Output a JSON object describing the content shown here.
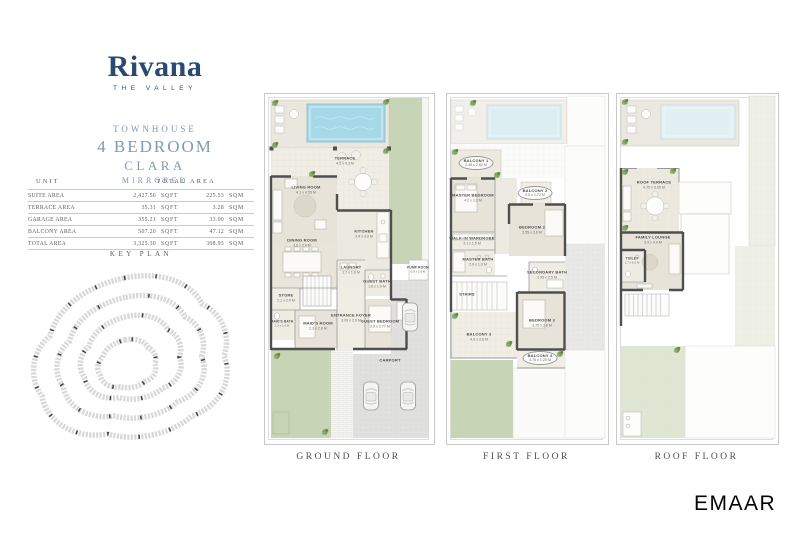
{
  "brand": {
    "logo": "Rivana",
    "tagline": "THE VALLEY",
    "emaar_logo": "EMAAR"
  },
  "unit": {
    "type": "TOWNHOUSE",
    "bedrooms": "4 BEDROOM",
    "name": "CLARA",
    "variant": "MIRRORED"
  },
  "colors": {
    "brand_navy": "#2b4a72",
    "subtitle_blue": "#7e9ab4",
    "pool_blue": "#a6d9e8",
    "garden_green": "#c7d4b5"
  },
  "area_table": {
    "header_unit": "UNIT",
    "header_total": "TOTAL AREA",
    "rows": [
      {
        "label": "SUITE AREA",
        "sqft": "2,427.56",
        "sqft_unit": "SQFT",
        "sqm": "225.53",
        "sqm_unit": "SQM"
      },
      {
        "label": "TERRACE AREA",
        "sqft": "35.31",
        "sqft_unit": "SQFT",
        "sqm": "3.28",
        "sqm_unit": "SQM"
      },
      {
        "label": "GARAGE AREA",
        "sqft": "355.21",
        "sqft_unit": "SQFT",
        "sqm": "33.00",
        "sqm_unit": "SQM"
      },
      {
        "label": "BALCONY AREA",
        "sqft": "507.20",
        "sqft_unit": "SQFT",
        "sqm": "47.12",
        "sqm_unit": "SQM"
      },
      {
        "label": "TOTAL AREA",
        "sqft": "3,325.30",
        "sqft_unit": "SQFT",
        "sqm": "308.93",
        "sqm_unit": "SQM"
      }
    ]
  },
  "key_plan": {
    "title": "KEY PLAN"
  },
  "floors": {
    "ground": {
      "label": "GROUND FLOOR",
      "rooms": {
        "terrace": {
          "name": "TERRACE",
          "dims": "4.5 x 4.3 M"
        },
        "living": {
          "name": "LIVING ROOM",
          "dims": "4.1 x 4.55 M"
        },
        "dining": {
          "name": "DINING ROOM",
          "dims": "3.6 x 2.4 M"
        },
        "kitchen": {
          "name": "KITCHEN",
          "dims": "3.4 x 3.9 M"
        },
        "laundry": {
          "name": "LAUNDRY",
          "dims": "1.7 x 1.9 M"
        },
        "guest_bath": {
          "name": "GUEST BATH",
          "dims": "1.6 x 1.9 M"
        },
        "guest_bedroom": {
          "name": "GUEST BEDROOM",
          "dims": "3.5 x 2.77 M"
        },
        "store": {
          "name": "STORE",
          "dims": "2.1 x 2.0 M"
        },
        "maids_bath": {
          "name": "MAID'S BATH",
          "dims": "1.3 x 1.6 M"
        },
        "maids_room": {
          "name": "MAID'S ROOM",
          "dims": "2.3 x 2.6 M"
        },
        "entrance_foyer": {
          "name": "ENTRANCE FOYER",
          "dims": "3.09 x 2.9 M"
        },
        "pump_room": {
          "name": "PUMP ROOM",
          "dims": "0.9 x 1.6 M"
        },
        "carport": {
          "name": "CARPORT"
        }
      }
    },
    "first": {
      "label": "FIRST FLOOR",
      "rooms": {
        "balcony1": {
          "name": "BALCONY 1",
          "dims": "2.49 x 2.62 M"
        },
        "master_bedroom": {
          "name": "MASTER BEDROOM",
          "dims": "4.2 x 3.2 M"
        },
        "balcony2": {
          "name": "BALCONY 2",
          "dims": "2.5 x 1.72 M"
        },
        "bedroom2": {
          "name": "BEDROOM 2",
          "dims": "3.55 x 3.6 M"
        },
        "walkin": {
          "name": "WALK-IN WARDROBE",
          "dims": "3.1 x 1.5 M"
        },
        "master_bath": {
          "name": "MASTER BATH",
          "dims": "2.9 x 1.9 M"
        },
        "stairs": {
          "name": "STAIRS"
        },
        "secondary_bath": {
          "name": "SECONDARY BATH",
          "dims": "1.95 x 2.5 M"
        },
        "bedroom3": {
          "name": "BEDROOM 3",
          "dims": "3.75 x 3.6 M"
        },
        "balcony3": {
          "name": "BALCONY 3",
          "dims": "4.0 x 3.6 M"
        },
        "balcony4": {
          "name": "BALCONY 4",
          "dims": "3.75 x 1.25 M"
        }
      }
    },
    "roof": {
      "label": "ROOF FLOOR",
      "rooms": {
        "roof_terrace": {
          "name": "ROOF TERRACE",
          "dims": "4.75 x 3.05 M"
        },
        "family_lounge": {
          "name": "FAMILY LOUNGE",
          "dims": "3.9 x 4.4 M"
        },
        "toilet": {
          "name": "TOILET",
          "dims": "1.7 x 1.6 M"
        }
      }
    }
  }
}
